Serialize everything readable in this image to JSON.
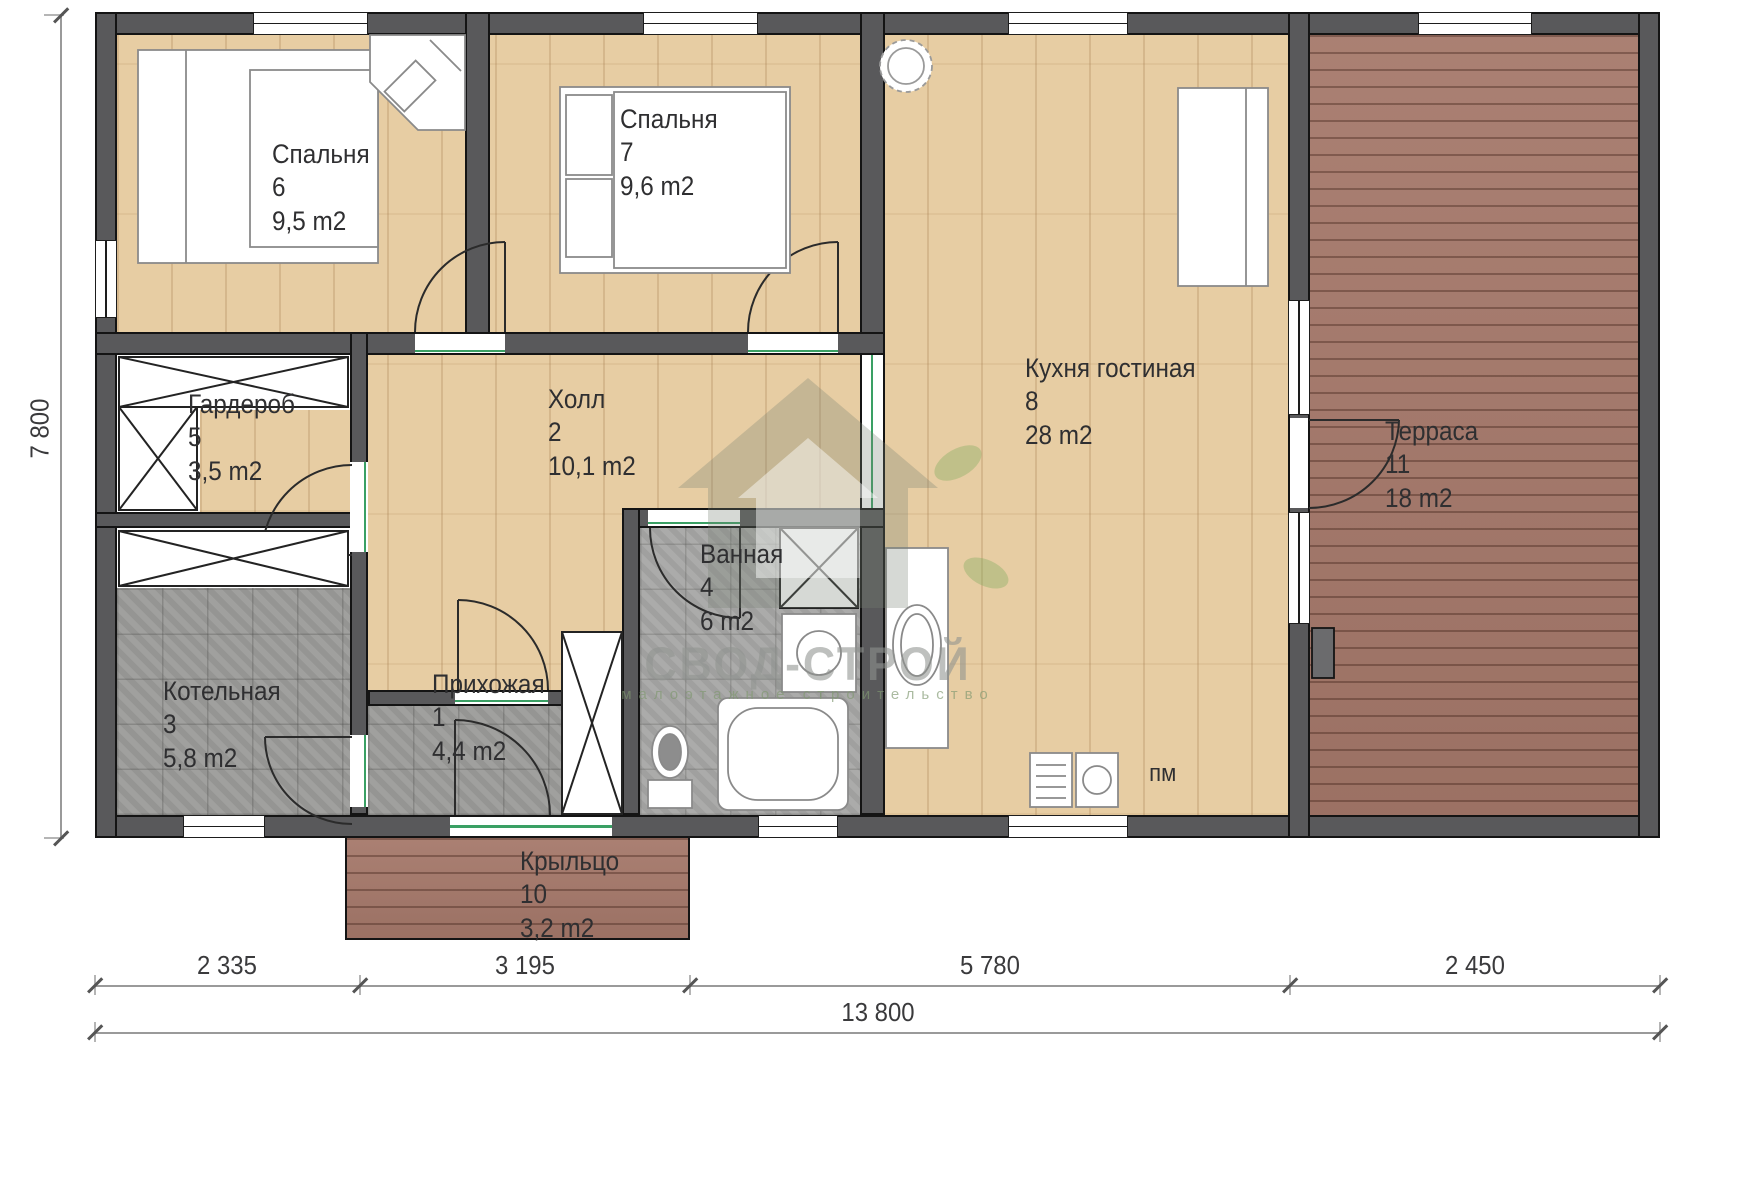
{
  "rooms": {
    "hallway": {
      "name": "Прихожая",
      "number": "1",
      "area": "4,4 m2"
    },
    "hall": {
      "name": "Холл",
      "number": "2",
      "area": "10,1 m2"
    },
    "boiler": {
      "name": "Котельная",
      "number": "3",
      "area": "5,8 m2"
    },
    "bathroom": {
      "name": "Ванная",
      "number": "4",
      "area": "6 m2"
    },
    "wardrobe": {
      "name": "Гардероб",
      "number": "5",
      "area": "3,5 m2"
    },
    "bedroom6": {
      "name": "Спальня",
      "number": "6",
      "area": "9,5 m2"
    },
    "bedroom7": {
      "name": "Спальня",
      "number": "7",
      "area": "9,6 m2"
    },
    "kitchen": {
      "name": "Кухня гостиная",
      "number": "8",
      "area": "28 m2"
    },
    "porch": {
      "name": "Крыльцо",
      "number": "10",
      "area": "3,2 m2"
    },
    "terrace": {
      "name": "Терраса",
      "number": "11",
      "area": "18 m2"
    }
  },
  "annotations": {
    "dishwasher": "пм"
  },
  "dimensions": {
    "left_total": "7 800",
    "bottom_segments": [
      "2 335",
      "3 195",
      "5 780",
      "2 450"
    ],
    "bottom_total": "13 800"
  },
  "watermark": {
    "brand": "СВОД-СТРОЙ",
    "tagline": "малоэтажное строительство"
  },
  "colors": {
    "wall": "#59595b",
    "wood_floor": "#e7cda3",
    "deck": "#a5786a",
    "tile": "#9b9b99",
    "accent_green": "#3aa064"
  }
}
